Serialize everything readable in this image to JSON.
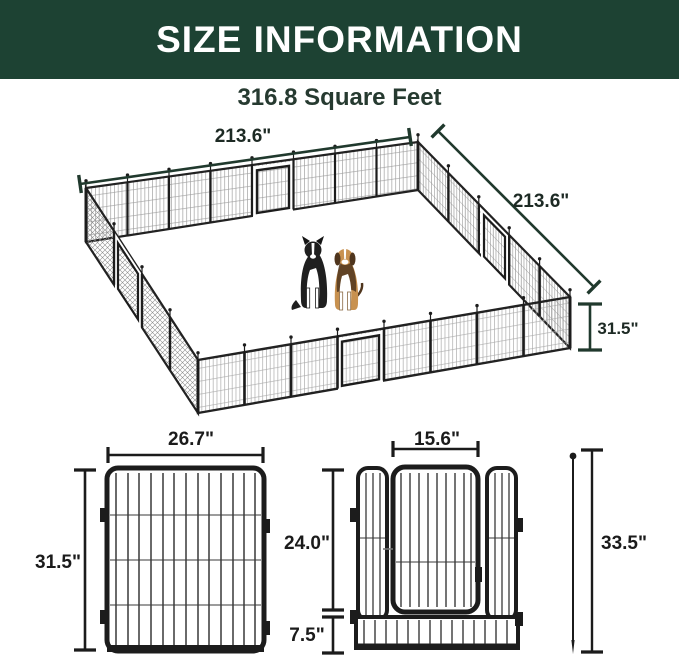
{
  "header": {
    "title": "SIZE INFORMATION"
  },
  "subtitle": "316.8 Square Feet",
  "pen": {
    "top_width_label": "213.6\"",
    "side_width_label": "213.6\"",
    "height_label": "31.5\"",
    "dogs": [
      "border collie",
      "beagle"
    ]
  },
  "solid_panel": {
    "width_label": "26.7\"",
    "height_label": "31.5\""
  },
  "door_panel": {
    "door_width_label": "15.6\"",
    "upper_height_label": "24.0\"",
    "bottom_height_label": "7.5\""
  },
  "stake": {
    "height_label": "33.5\""
  },
  "colors": {
    "header_bg": "#1d4233",
    "header_text": "#ffffff",
    "subtitle_text": "#263a30",
    "dimension_line_green": "#20392d",
    "dimension_text_dark": "#1d2a24",
    "dimension_black": "#1b1b1b",
    "frame_black": "#1c1c1c",
    "mesh_gray": "#9a9a9a",
    "dog_collie_black": "#1f1f1f",
    "dog_beagle_tan": "#c8914f",
    "dog_beagle_brown": "#4f351d"
  }
}
